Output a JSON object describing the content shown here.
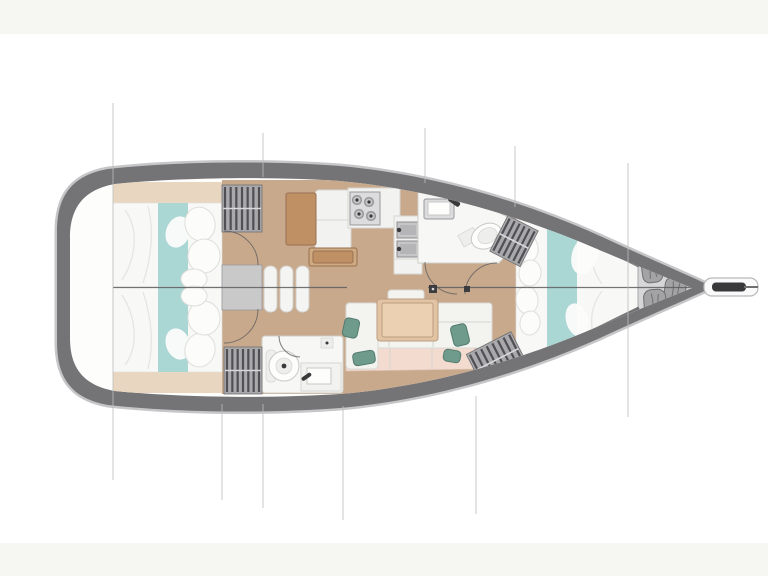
{
  "diagram": {
    "type": "yacht-floor-plan",
    "view": "top-down",
    "orientation": "bow-right",
    "areas": [
      {
        "id": "transom-deck",
        "label": "aft deck / transom"
      },
      {
        "id": "aft-cabin-port",
        "label": "aft cabin port berth"
      },
      {
        "id": "aft-cabin-starboard",
        "label": "aft cabin starboard berth"
      },
      {
        "id": "companionway",
        "label": "companionway steps"
      },
      {
        "id": "nav-station",
        "label": "chart table / nav station"
      },
      {
        "id": "galley",
        "label": "galley with stove and double sink"
      },
      {
        "id": "aft-head",
        "label": "aft head (toilet + sink)"
      },
      {
        "id": "forward-head",
        "label": "forward head (toilet + sink)"
      },
      {
        "id": "saloon",
        "label": "saloon settee with table"
      },
      {
        "id": "forward-cabin",
        "label": "forward V-berth cabin"
      },
      {
        "id": "sail-locker",
        "label": "bow sail locker with gear bags"
      },
      {
        "id": "bowsprit",
        "label": "bowsprit with anchor roller"
      }
    ]
  },
  "colors": {
    "background": "#ffffff",
    "band": "#f6f6f3",
    "hull": "#747477",
    "hull_halo": "#c6c6c8",
    "interior": "#fdfdfc",
    "floor": "#c8a98c",
    "shelf": "#e9d6c0",
    "bedding": "#f8f8f7",
    "bedding_edge": "#e0e0dc",
    "bedding_fold": "#e6e6e2",
    "teal": "#aad6d3",
    "pillow": "#fcfcfb",
    "pillow_edge": "#dededa",
    "locker_base": "#a9a9ac",
    "locker_slat": "#4f4f54",
    "locker_gap": "#d8d8da",
    "platform": "#c9c9ca",
    "step": "#f4f4f2",
    "step_edge": "#cfcfcb",
    "wood": "#c09065",
    "wood_edge": "#997052",
    "wood_light": "#cdaa80",
    "counter": "#f2f2f0",
    "counter_edge": "#d5d5d1",
    "appliance": "#dcdcde",
    "appliance_edge": "#99999c",
    "sink": "#c6c6c8",
    "sink_edge": "#8e8e91",
    "fixture_dark": "#39393b",
    "bath": "#f7f7f5",
    "bath_edge": "#cfcfcc",
    "table": "#e2c3a3",
    "table_edge": "#bb9d7e",
    "cushion": "#f3f3f0",
    "cushion_edge": "#d8d8d4",
    "cushion_back": "#f3dccf",
    "cushion_back_edge": "#ddc3b5",
    "green": "#6f9b8c",
    "green_edge": "#527b6e",
    "locker_bag": "#a3a3a6",
    "locker_bag_edge": "#6f6f72",
    "locker_floor": "#d6d6d8",
    "bulkhead": "#717174",
    "centerline": "#5d5d60",
    "section_line": "#bdbdbd",
    "arc": "#5f5f62",
    "mast": "#3c3c3f"
  },
  "section_lines": [
    {
      "x": 113,
      "y1": 103,
      "y2": 480
    },
    {
      "x": 222,
      "y1": 404,
      "y2": 500
    },
    {
      "x": 263,
      "y1": 133,
      "y2": 177
    },
    {
      "x": 263,
      "y1": 404,
      "y2": 508
    },
    {
      "x": 343,
      "y1": 406,
      "y2": 520
    },
    {
      "x": 425,
      "y1": 128,
      "y2": 183
    },
    {
      "x": 476,
      "y1": 396,
      "y2": 514
    },
    {
      "x": 515,
      "y1": 146,
      "y2": 207
    },
    {
      "x": 628,
      "y1": 163,
      "y2": 417
    }
  ],
  "centerline": {
    "y": 287.5,
    "segments": [
      [
        113,
        347
      ],
      [
        428,
        704
      ],
      [
        704,
        757
      ]
    ]
  },
  "lockers": [
    {
      "id": "wardrobe-aft-port",
      "x": 222,
      "y": 185,
      "w": 40,
      "h": 47,
      "rot": 0,
      "rows": 2,
      "slats": 7
    },
    {
      "id": "wardrobe-aft-starboard",
      "x": 224,
      "y": 347,
      "w": 38,
      "h": 47,
      "rot": 0,
      "rows": 2,
      "slats": 7
    },
    {
      "id": "locker-forward-port",
      "x": 497,
      "y": 221,
      "w": 34,
      "h": 40,
      "rot": 27,
      "rows": 2,
      "slats": 6
    },
    {
      "id": "locker-forward-starboard",
      "x": 472,
      "y": 341,
      "w": 50,
      "h": 37,
      "rot": -27,
      "rows": 2,
      "slats": 8
    }
  ],
  "stove_burners": [
    {
      "cx": 357,
      "cy": 200
    },
    {
      "cx": 369,
      "cy": 202
    },
    {
      "cx": 359,
      "cy": 214
    },
    {
      "cx": 371,
      "cy": 216
    }
  ],
  "sail_bags": [
    {
      "cx": 652,
      "cy": 270,
      "w": 20,
      "h": 25,
      "rot": -8
    },
    {
      "cx": 675,
      "cy": 291,
      "w": 21,
      "h": 27,
      "rot": 7
    },
    {
      "cx": 655,
      "cy": 303,
      "w": 22,
      "h": 27,
      "rot": -4
    }
  ],
  "green_pillows": [
    {
      "cx": 351,
      "cy": 328,
      "w": 15,
      "h": 19,
      "rot": 12
    },
    {
      "cx": 364,
      "cy": 358,
      "w": 22,
      "h": 13,
      "rot": -10
    },
    {
      "cx": 460,
      "cy": 335,
      "w": 16,
      "h": 21,
      "rot": -14
    },
    {
      "cx": 452,
      "cy": 356,
      "w": 17,
      "h": 12,
      "rot": 10
    }
  ],
  "bed_pillows": [
    {
      "cx": 200,
      "cy": 224,
      "rx": 15,
      "ry": 17,
      "rot": -15
    },
    {
      "cx": 204,
      "cy": 256,
      "rx": 16,
      "ry": 17,
      "rot": 10
    },
    {
      "cx": 194,
      "cy": 279,
      "rx": 13,
      "ry": 10,
      "rot": 0
    },
    {
      "cx": 200,
      "cy": 350,
      "rx": 15,
      "ry": 17,
      "rot": 15
    },
    {
      "cx": 204,
      "cy": 318,
      "rx": 16,
      "ry": 17,
      "rot": -10
    },
    {
      "cx": 194,
      "cy": 296,
      "rx": 13,
      "ry": 10,
      "rot": 0
    },
    {
      "cx": 527,
      "cy": 248,
      "rx": 11,
      "ry": 14,
      "rot": -12
    },
    {
      "cx": 530,
      "cy": 273,
      "rx": 11,
      "ry": 13,
      "rot": 8
    },
    {
      "cx": 527,
      "cy": 300,
      "rx": 11,
      "ry": 14,
      "rot": -6
    },
    {
      "cx": 530,
      "cy": 323,
      "rx": 10,
      "ry": 12,
      "rot": 10
    }
  ],
  "duvet_blobs": [
    {
      "cx": 585,
      "cy": 255,
      "rx": 13,
      "ry": 20,
      "rot": 18
    },
    {
      "cx": 577,
      "cy": 320,
      "rx": 11,
      "ry": 17,
      "rot": -15
    },
    {
      "cx": 178,
      "cy": 232,
      "rx": 12,
      "ry": 16,
      "rot": 20
    },
    {
      "cx": 178,
      "cy": 344,
      "rx": 12,
      "ry": 16,
      "rot": -20
    }
  ],
  "steps": {
    "x": 264,
    "y": 266,
    "count": 3,
    "w": 13,
    "h": 46,
    "pitch": 16
  },
  "door_arcs": [
    "M 224 231 A 34 34 0 0 1 258 265",
    "M 224 343 A 34 34 0 0 0 258 309",
    "M 279 336 A 21 21 0 0 0 300 357",
    "M 425 262 A 32 32 0 0 0 457 294",
    "M 497 263 A 32 32 0 0 0 465 294"
  ]
}
